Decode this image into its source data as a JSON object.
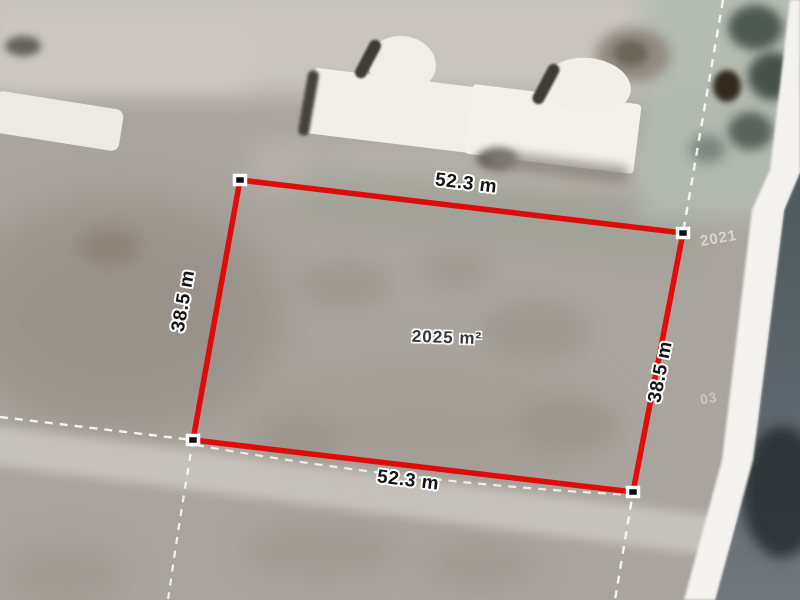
{
  "plot": {
    "area": "2025 m²",
    "width_top": "52.3 m",
    "width_bottom": "52.3 m",
    "height_left": "38.5 m",
    "height_right": "38.5 m",
    "boundary_color": "#e10400",
    "cadastral_line_color": "#fafaf7",
    "corner_marker_fill": "#0d0d0d"
  },
  "watermarks": {
    "year": "2021",
    "mark": "03"
  }
}
